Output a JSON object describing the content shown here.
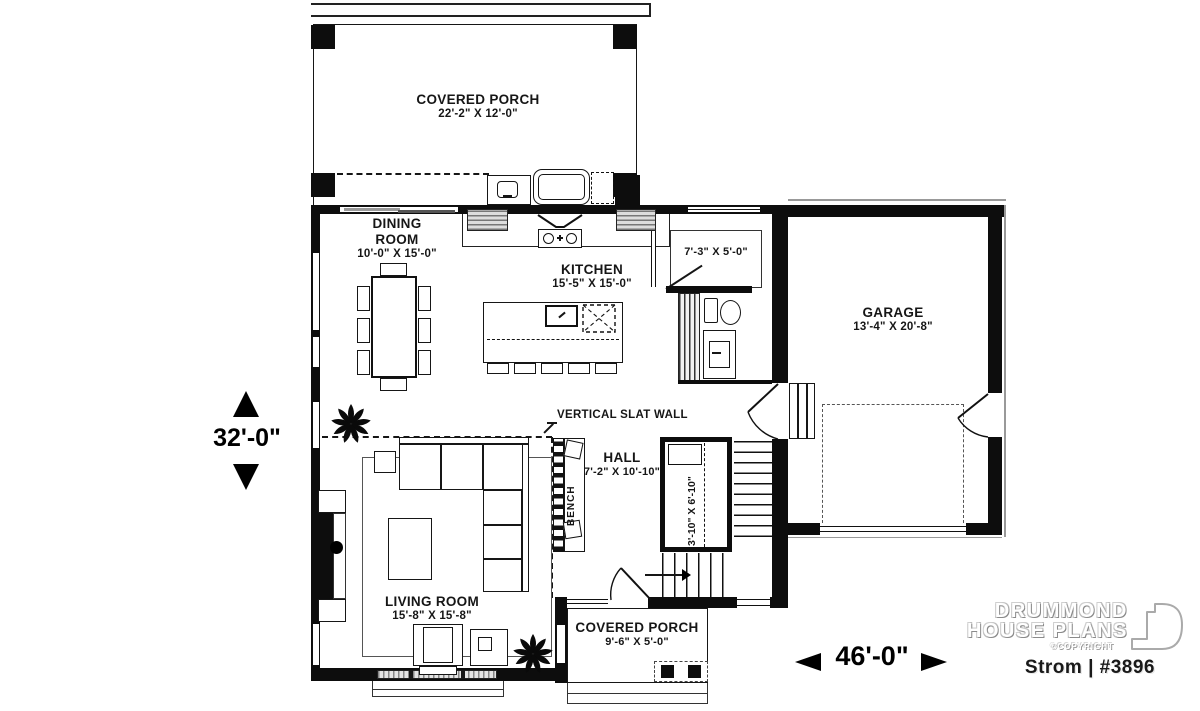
{
  "branding": {
    "line1": "DRUMMOND",
    "line2": "HOUSE PLANS",
    "copyright": "©COPYRIGHT",
    "plan_id": "Strom | #3896"
  },
  "dims": {
    "height": "32'-0\"",
    "width": "46'-0\""
  },
  "rooms": {
    "porch_top": {
      "name": "COVERED PORCH",
      "size": "22'-2\" X 12'-0\""
    },
    "dining": {
      "name": "DINING ROOM",
      "size": "10'-0\" X 15'-0\""
    },
    "kitchen": {
      "name": "KITCHEN",
      "size": "15'-5\" X 15'-0\""
    },
    "mudroom": {
      "size": "7'-3\" X 5'-0\""
    },
    "garage": {
      "name": "GARAGE",
      "size": "13'-4\" X 20'-8\""
    },
    "hall": {
      "name": "HALL",
      "size": "7'-2\" X 10'-10\""
    },
    "stairwell": {
      "size": "3'-10\" X 6'-10\""
    },
    "living": {
      "name": "LIVING ROOM",
      "size": "15'-8\" X 15'-8\""
    },
    "porch_front": {
      "name": "COVERED PORCH",
      "size": "9'-6\" X 5'-0\""
    }
  },
  "annotations": {
    "slat_wall": "VERTICAL SLAT WALL",
    "bench": "BENCH"
  },
  "colors": {
    "wall": "#0d0d0d",
    "line": "#161616",
    "roof_gray": "#999999",
    "brand_outline": "#aaaaaa"
  }
}
